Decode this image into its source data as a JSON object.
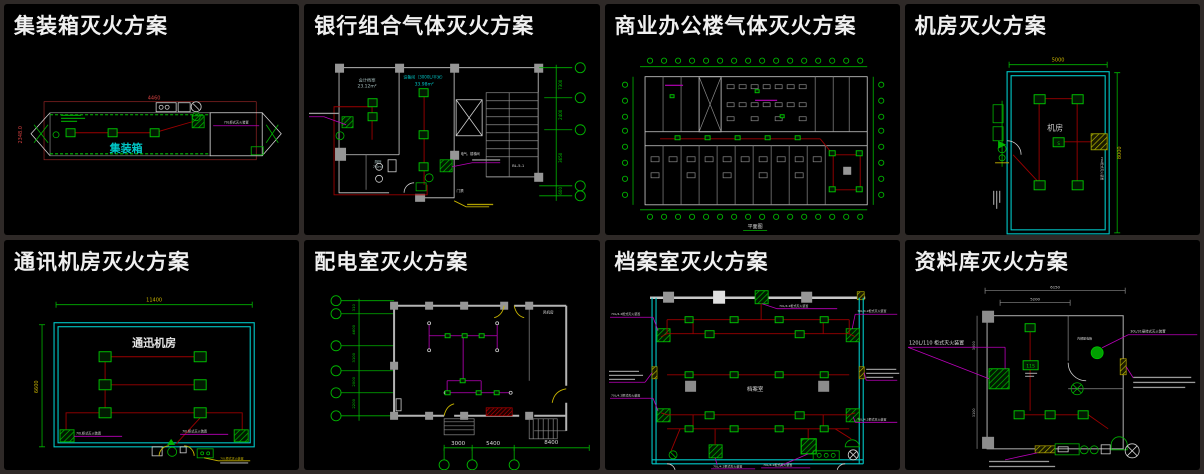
{
  "page": {
    "background": "#2e2927",
    "panel_background": "#000000"
  },
  "colors": {
    "title": "#f0f0f0",
    "cad_green": "#00b400",
    "cad_cyan": "#00c8c8",
    "cad_red": "#9c0000",
    "cad_bright_red": "#c83232",
    "cad_magenta": "#bb00bb",
    "cad_yellow": "#c8b400",
    "cad_white": "#dcdcdc",
    "cad_gray": "#8c8c8c"
  },
  "panels": [
    {
      "title": "集装箱灭火方案",
      "room_label": "集装箱",
      "dim_top": "4460",
      "dim_left": "2348.0",
      "device_label": "70L柜式灭火装置"
    },
    {
      "title": "银行组合气体灭火方案",
      "room1_name": "会计档案",
      "room1_area": "23.12m²",
      "room2_name": "设备间（3000L/平米）",
      "room2_area": "33.98m²",
      "room3_name": "厕所",
      "room3_area": "7.0m²",
      "shaft_label": "电气、楼梯间",
      "door_label": "门禁",
      "stair_label": "BL-5-1",
      "dims": [
        "7300",
        "2400",
        "3650",
        "600"
      ]
    },
    {
      "title": "商业办公楼气体灭火方案",
      "caption": "平面图"
    },
    {
      "title": "机房灭火方案",
      "room_label": "机房",
      "dim_top": "5000",
      "dim_right": "8000",
      "device_label": "70L柜式灭火装置"
    },
    {
      "title": "通讯机房灭火方案",
      "room_label": "通迅机房",
      "dim_top": "11400",
      "dim_left": "6600",
      "device_label_left": "70L柜式灭火装置",
      "device_label_right": "70L柜式灭火装置",
      "note_label": "70L柜式灭火装置"
    },
    {
      "title": "配电室灭火方案",
      "room_label": "风机房",
      "dims_left": [
        "310",
        "4600",
        "3100",
        "2000",
        "2200"
      ],
      "dims_bottom": [
        "3000",
        "5400",
        "8400"
      ]
    },
    {
      "title": "档案室灭火方案",
      "room_label": "档案室",
      "label_top": "70L/4.2柜式灭火装置",
      "label_left_top": "70L/4.2柜式灭火装置",
      "label_right_top": "70L/4.2柜式灭火装置",
      "label_left_bottom": "70L/4.2柜式灭火装置",
      "label_right_bottom": "70L/4.2柜式灭火装置",
      "label_bottom_left": "70L/4.2柜式灭火装置",
      "label_bottom_right": "70L/4.2柜式灭火装置"
    },
    {
      "title": "资料库灭火方案",
      "label_cabinet": "120L/110 柜式灭火装置",
      "label_hanging": "30L/31悬挂式灭火装置",
      "label_box": "内部配电箱",
      "nozzle_label": "11S",
      "dim_top_outer": "6150",
      "dim_top_inner": "5200",
      "dim_left_upper": "3000",
      "dim_left_lower": "3100"
    }
  ]
}
